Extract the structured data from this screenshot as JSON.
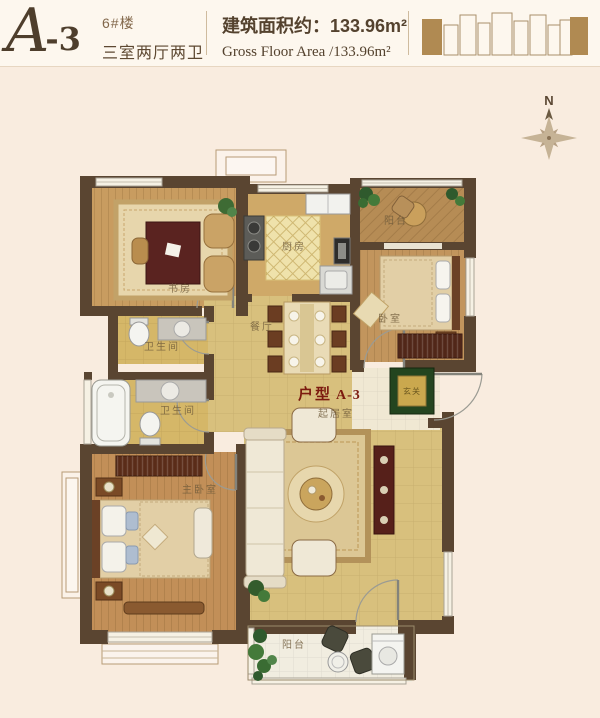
{
  "header": {
    "unit_code_script": "A",
    "unit_code_rest": "-3",
    "building_no": "6#楼",
    "layout_type": "三室两厅两卫",
    "area_cn": "建筑面积约：133.96m²",
    "area_en": "Gross Floor Area /133.96m²"
  },
  "compass": {
    "north_label": "N"
  },
  "unit_tag": {
    "prefix": "户型",
    "code": "A-3"
  },
  "rooms": {
    "study": {
      "label": "书房"
    },
    "kitchen": {
      "label": "厨房"
    },
    "balcony_top": {
      "label": "阳台"
    },
    "bedroom": {
      "label": "卧室"
    },
    "bathroom_upper": {
      "label": "卫生间"
    },
    "bathroom_lower": {
      "label": "卫生间"
    },
    "dining": {
      "label": "餐厅"
    },
    "entry": {
      "label": "玄关"
    },
    "living": {
      "label": "起居室"
    },
    "master_bedroom": {
      "label": "主卧室"
    },
    "balcony_bottom": {
      "label": "阳台"
    }
  },
  "colors": {
    "wall": "#5a4531",
    "wood_floor": "#c89c60",
    "tile_floor": "#d8c07d",
    "accent_dark_red": "#7c1a0f",
    "page_bg": "#f9ecdf",
    "header_bg": "#fdf7ee"
  }
}
